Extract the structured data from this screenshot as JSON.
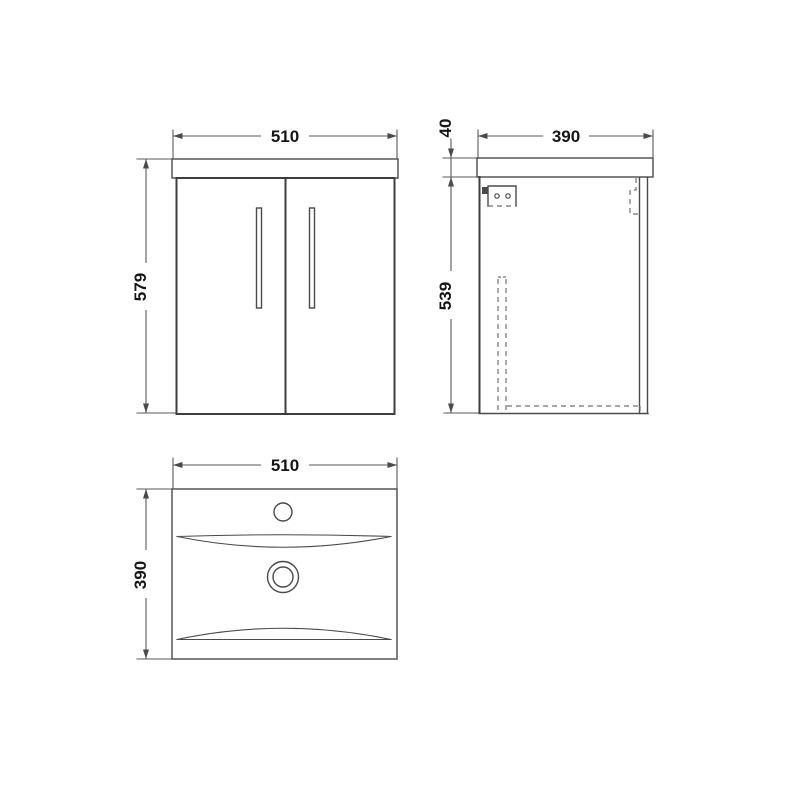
{
  "drawing": {
    "front_view": {
      "width_label": "510",
      "height_label": "579"
    },
    "side_view": {
      "depth_label": "390",
      "counter_thickness_label": "40",
      "cabinet_height_label": "539"
    },
    "plan_view": {
      "width_label": "510",
      "depth_label": "390"
    }
  },
  "colors": {
    "background": "#ffffff",
    "object_line": "#4a4a4a",
    "dimension_line": "#5a5a5a",
    "hidden_line": "#707070",
    "label_text": "#151515"
  }
}
